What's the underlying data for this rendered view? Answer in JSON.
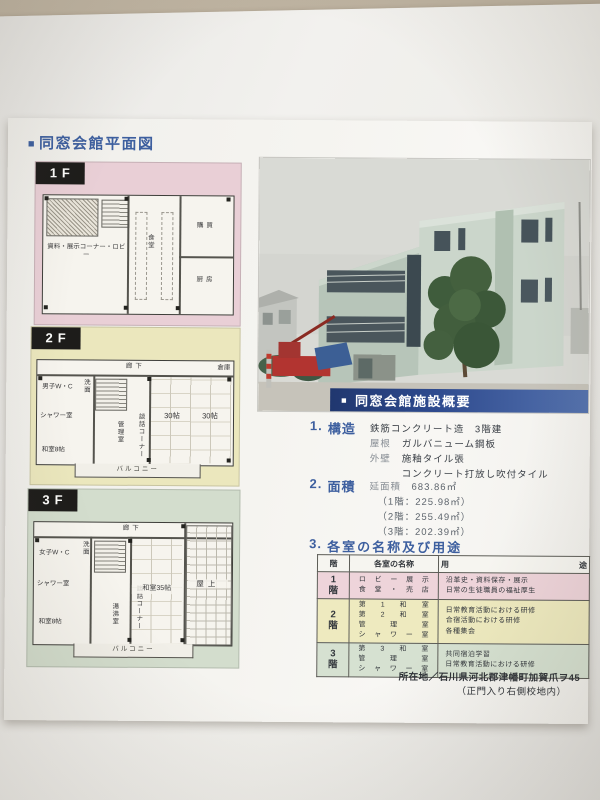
{
  "page_heading": {
    "bullet": "■",
    "text": "同窓会館平面図"
  },
  "floors": {
    "f1": {
      "tab": "1F",
      "room_lobby": "資料・展示コーナー・ロビー",
      "room_dining": "食堂",
      "room_shop": "購買",
      "room_kitchen": "厨房"
    },
    "f2": {
      "tab": "2F",
      "corridor": "廊下",
      "storage": "倉庫",
      "wc": "男子W・C",
      "washroom": "洗面",
      "shower": "シャワー室",
      "washitsu8": "和室8帖",
      "kanri": "管理室",
      "danwa": "談話コーナー",
      "tatami_a": "30帖",
      "tatami_b": "30帖",
      "balcony": "バルコニー"
    },
    "f3": {
      "tab": "3F",
      "corridor": "廊下",
      "wc": "女子W・C",
      "washroom": "洗面",
      "shower": "シャワー室",
      "washitsu8": "和室8帖",
      "yuwakashi": "湯沸室",
      "danwa": "談話コーナー",
      "washitsu35": "和室35帖",
      "rooftop": "屋上",
      "balcony": "バルコニー"
    }
  },
  "overview": {
    "banner_bullet": "■",
    "banner_title": "同窓会館施設概要",
    "s1_no": "1.",
    "s1_title": "構造",
    "s1_line1": "鉄筋コンクリート造　3階建",
    "s1_l2_label": "屋根",
    "s1_l2_value": "ガルバニューム鋼板",
    "s1_l3_label": "外壁",
    "s1_l3_value": "施釉タイル張",
    "s1_line4": "コンクリート打放し吹付タイル",
    "s2_no": "2.",
    "s2_title": "面積",
    "s2_label": "延面積",
    "s2_value": "683.86㎡",
    "s2_f1": "（1階：225.98㎡）",
    "s2_f2": "（2階：255.49㎡）",
    "s2_f3": "（3階：202.39㎡）",
    "s3_no": "3.",
    "s3_title": "各室の名称及び用途"
  },
  "table": {
    "h_floor": "階",
    "h_name": "各室の名称",
    "h_use": "用途",
    "rows": [
      {
        "no": "1",
        "kai": "階",
        "names": [
          "ロビー展示",
          "食堂・売店"
        ],
        "uses": [
          "沿革史・資料保存・展示",
          "日常の生徒職員の福祉厚生"
        ]
      },
      {
        "no": "2",
        "kai": "階",
        "names": [
          "第1和室",
          "第2和室",
          "管理室",
          "シャワー室"
        ],
        "uses": [
          "日常教育活動における研修",
          "合宿活動における研修",
          "各種集会"
        ]
      },
      {
        "no": "3",
        "kai": "階",
        "names": [
          "第3和室",
          "管理室",
          "シャワー室"
        ],
        "uses": [
          "共同宿泊学習",
          "日常教育活動における研修"
        ]
      }
    ]
  },
  "address": {
    "label": "所在地／",
    "line1": "石川県河北郡津幡町加賀爪ヲ45",
    "line2": "（正門入り右側校地内）"
  },
  "colors": {
    "accent_blue": "#3d5f9f",
    "banner_blue": "#2e4a8e",
    "panel_pink": "#e9cfd6",
    "panel_yellow": "#ebe7bd",
    "panel_green": "#d3ddcd"
  }
}
